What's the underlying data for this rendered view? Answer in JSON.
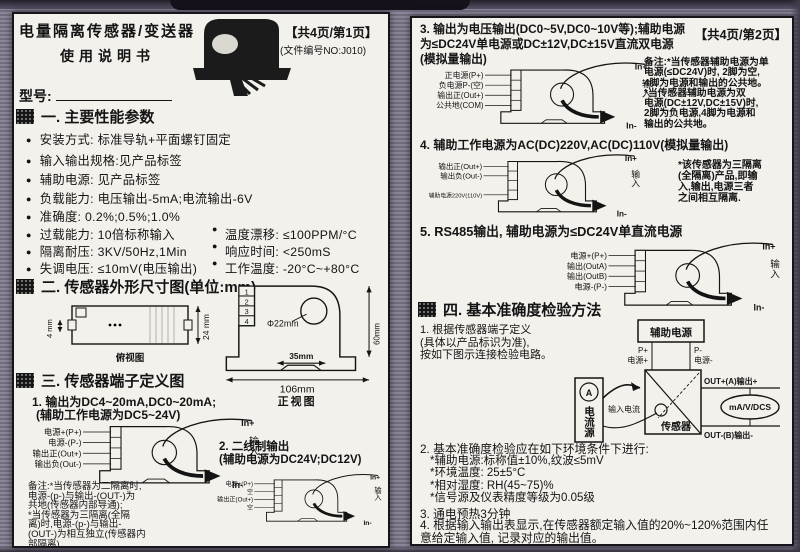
{
  "colors": {
    "page_bg": "#f3f1ec",
    "ink": "#141414",
    "scan_bg": "#8d8799"
  },
  "sensor": {
    "in_plus": "In+",
    "input": "输入",
    "in_minus": "In-"
  },
  "p1": {
    "title": "电量隔离传感器/变送器",
    "subtitle": "使用说明书",
    "page_marker": "【共4页/第1页】",
    "doc_no": "(文件编号NO:J010)",
    "model_label": "型号:",
    "s1_heading": "一. 主要性能参数",
    "params": [
      {
        "l": "安装方式: 标准导轨+平面螺钉固定"
      },
      {
        "l": "输入输出规格:见产品标签"
      },
      {
        "l": "辅助电源: 见产品标签"
      },
      {
        "l": "负载能力: 电压输出-5mA;电流输出-6V"
      },
      {
        "l": "准确度: 0.2%;0.5%;1.0%"
      },
      {
        "l": "过载能力: 10倍标称输入",
        "r": "温度漂移: ≤100PPM/°C"
      },
      {
        "l": "隔离耐压: 3KV/50Hz,1Min",
        "r": "响应时间: <250mS"
      },
      {
        "l": "失调电压: ≤10mV(电压输出)",
        "r": "工作温度: -20°C~+80°C"
      }
    ],
    "s2_heading": "二. 传感器外形尺寸图(单位:mm)",
    "dims": {
      "h4": "4 mm",
      "h24": "24 mm",
      "top_caption": "俯视图",
      "dia": "Φ22mm",
      "h60": "60mm",
      "w35": "35mm",
      "w106": "106mm",
      "front_caption": "正视图",
      "pins": [
        "1",
        "2",
        "3",
        "4"
      ]
    },
    "s3_heading": "三. 传感器端子定义图",
    "d1": {
      "t1": "1. 输出为DC4~20mA,DC0~20mA;",
      "t2": "(辅助工作电源为DC5~24V)",
      "pins": [
        "电源+(P+)",
        "电源-(P-)",
        "输出正(Out+)",
        "输出负(Out-)"
      ]
    },
    "note1": "备注:*当传感器为二隔离时,\n电源-(p-)与输出-(OUT-)为\n共地(传感器内部导通);\n  *当传感器为三隔离(全隔\n离)时,电源-(p-)与输出-\n(OUT-)为相互独立(传感器内\n部隔离)",
    "d2": {
      "t1": "2. 二线制输出",
      "t2": "(辅助电源为DC24V;DC12V)",
      "pins": [
        "电源+(P+)",
        "空",
        "输出正(Out+)",
        "空"
      ]
    }
  },
  "p2": {
    "page_marker": "【共4页/第2页】",
    "s3_title": "3. 输出为电压输出(DC0~5V,DC0~10V等);辅助电源\n  为≤DC24V单电源或DC±12V,DC±15V直流双电源\n  (模拟量输出)",
    "d3": {
      "pins": [
        "正电源(P+)",
        "负电源P-(空)",
        "输出正(Out+)",
        "公共地(COM)"
      ]
    },
    "note3": "备注:*当传感器辅助电源为单\n电源(≤DC24V)时, 2脚为空,\n4脚为电源和输出的公共地。\n  *当传感器辅助电源为双\n电源(DC±12V,DC±15V)时,\n2脚为负电源,4脚为电源和\n输出的公共地。",
    "s4_title": "4. 辅助工作电源为AC(DC)220V,AC(DC)110V(模拟量输出)",
    "d4": {
      "pins": [
        "输出正(Out+)",
        "输出负(Out-)",
        "辅助电源220V(110V)"
      ]
    },
    "note4": "*该传感器为三隔离\n(全隔离)产品,即输\n入,输出,电源三者\n之间相互隔离.",
    "s5_title": "5. RS485输出, 辅助电源为≤DC24V单直流电源",
    "d5": {
      "pins": [
        "电源+(P+)",
        "输出(OutA)",
        "输出(OutB)",
        "电源-(P-)"
      ]
    },
    "s6_heading": "四. 基本准确度检验方法",
    "item1": "1. 根据传感器端子定义\n(具体以产品标识为准),\n 按如下图示连接检验电路。",
    "circuit": {
      "aux": "辅助电源",
      "pp": "P+",
      "pp2": "电源+",
      "pm": "P-",
      "pm2": "电源-",
      "amm": "A",
      "src": "电流源",
      "in_cur": "输入电流",
      "sensor": "传感器",
      "outp": "OUT+(A)输出+",
      "outm": "OUT-(B)输出-",
      "meter": "mA/V/DCS"
    },
    "item2": "2. 基本准确度检验应在如下环境条件下进行:",
    "item2_subs": "*辅助电源:标称值±10%,纹波≤5mV\n*环境温度: 25±5°C\n*相对湿度: RH(45~75)%\n*信号源及仪表精度等级为0.05级",
    "item3": "3. 通电预热3分钟",
    "item4": "4. 根据输入输出表显示,在传感器额定输入值的20%~120%范围内任\n 意给定输入值, 记录对应的输出值。"
  }
}
